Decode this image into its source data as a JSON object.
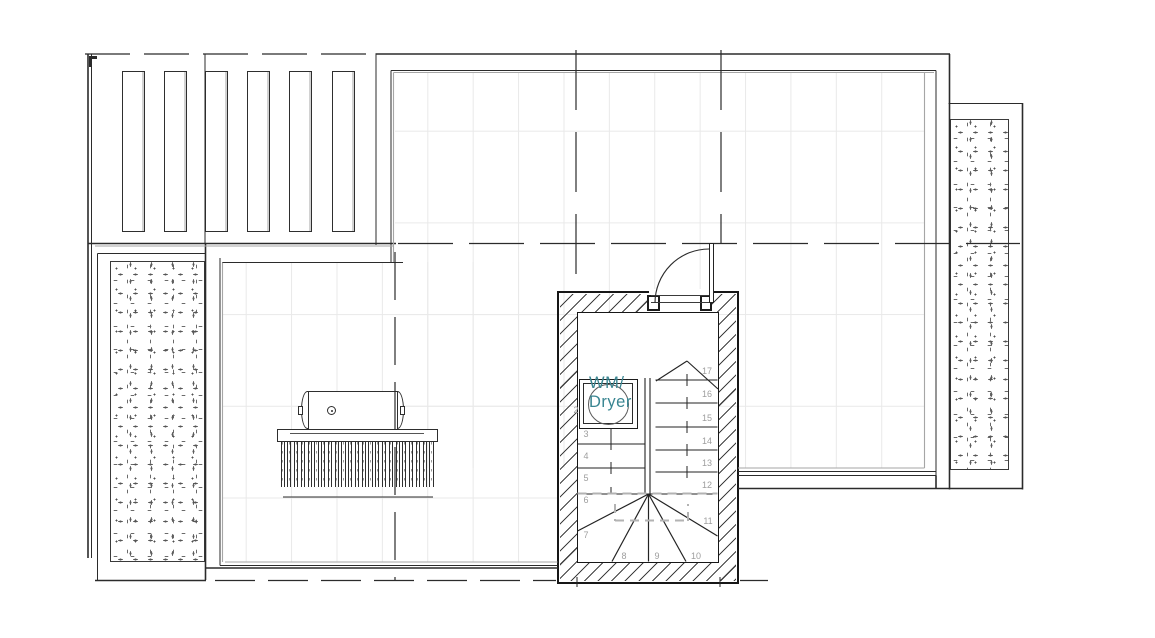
{
  "appliance": {
    "line1": "WM/",
    "line2": "Dryer"
  },
  "stair": {
    "treads": [
      {
        "label": "2"
      },
      {
        "label": "3"
      },
      {
        "label": "4"
      },
      {
        "label": "5"
      },
      {
        "label": "6"
      },
      {
        "label": "7"
      },
      {
        "label": "8"
      },
      {
        "label": "9"
      },
      {
        "label": "10"
      },
      {
        "label": "11"
      },
      {
        "label": "12"
      },
      {
        "label": "13"
      },
      {
        "label": "14"
      },
      {
        "label": "15"
      },
      {
        "label": "16"
      },
      {
        "label": "17"
      }
    ]
  },
  "colors": {
    "line": "#2b2b2b",
    "wall_gray_face": "#a6a6a6",
    "tread_number_gray": "#9e9e9e",
    "appliance_teal": "#398591",
    "tile_grid": "#e9e9e9",
    "hatch": "#3f3f3f"
  }
}
